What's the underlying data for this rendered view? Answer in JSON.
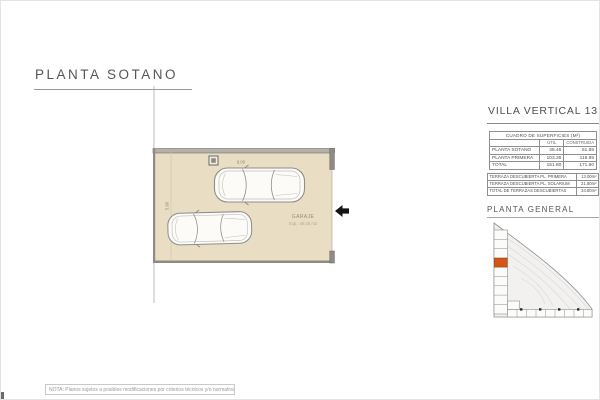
{
  "page": {
    "title": "PLANTA SOTANO",
    "note": "NOTA: Planos sujetos a posibles modificaciones por criterios técnicos y/o normativa sectorial."
  },
  "floorplan": {
    "room_label": "GARAJE",
    "room_area": "Sup.: 48.45 m2",
    "dim_top": "9.00",
    "dim_left": "5.90"
  },
  "panel": {
    "title": "VILLA VERTICAL 13",
    "surfaces": {
      "caption": "CUADRO DE SUPERFICIES (M²)",
      "columns": {
        "util": "ÚTIL",
        "construida": "CONSTRUIDA"
      },
      "rows": [
        {
          "label": "PLANTA SOTANO",
          "util": "48.45",
          "construida": "51.85"
        },
        {
          "label": "PLANTA PRIMERA",
          "util": "103.35",
          "construida": "119.95"
        },
        {
          "label": "TOTAL",
          "util": "151.80",
          "construida": "171.80"
        }
      ]
    },
    "terraces": {
      "rows": [
        {
          "label": "TERRAZA DESCUBIERTA PL. PRIMERA",
          "value": "13.00m²"
        },
        {
          "label": "TERRAZA DESCUBIERTA PL. SOLARIUM",
          "value": "21.80m²"
        },
        {
          "label": "TOTAL DE TERRAZAS DESCUBIERTAS",
          "value": "34.80m²"
        }
      ]
    },
    "siteplan_label": "PLANTA GENERAL"
  },
  "colors": {
    "floor_beige": "#e9ddc4",
    "wall_gray": "#8f8b83",
    "highlight_orange": "#d4571a"
  }
}
